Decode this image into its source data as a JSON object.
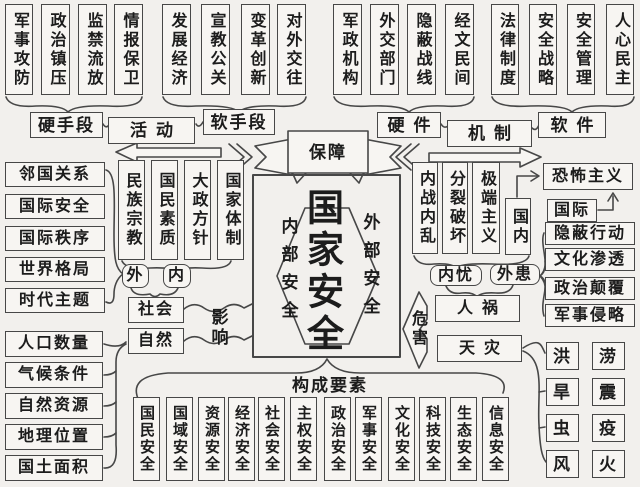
{
  "colors": {
    "background": "#f2f0ed",
    "box_background": "#f7f5f2",
    "border": "#474747",
    "text": "#1c1c1c"
  },
  "center": {
    "title": "国家安全",
    "inner_label": "内部安全",
    "outer_label": "外部安全"
  },
  "banner": {
    "label": "保障"
  },
  "top_left": {
    "hard_items": [
      "军事攻防",
      "政治镇压",
      "监禁流放",
      "情报保卫"
    ],
    "hard_label": "硬手段",
    "activity_label": "活动",
    "soft_items": [
      "发展经济",
      "宣教公关",
      "变革创新",
      "对外交往"
    ],
    "soft_label": "软手段"
  },
  "top_right": {
    "hardware_items": [
      "军政机构",
      "外交部门",
      "隐蔽战线",
      "经文民间"
    ],
    "hardware_label": "硬件",
    "mechanism_label": "机制",
    "software_items": [
      "法律制度",
      "安全战略",
      "安全管理",
      "人心民主"
    ],
    "software_label": "软件"
  },
  "left": {
    "world_items": [
      "邻国关系",
      "国际安全",
      "国际秩序",
      "世界格局",
      "时代主题"
    ],
    "domestic_items": [
      "民族宗教",
      "国民素质",
      "大政方针",
      "国家体制"
    ],
    "external_label": "外",
    "internal_label": "内",
    "society_label": "社会",
    "nature_label": "自然",
    "influence_label": "影响",
    "geo_items": [
      "人口数量",
      "气候条件",
      "自然资源",
      "地理位置",
      "国土面积"
    ]
  },
  "right": {
    "internal_threat_items": [
      "内战内乱",
      "分裂破坏",
      "极端主义"
    ],
    "domestic_label": "国内",
    "terrorism_label": "恐怖主义",
    "international_label": "国际",
    "external_threat_items": [
      "隐蔽行动",
      "文化渗透",
      "政治颠覆",
      "军事侵略"
    ],
    "internal_worry_label": "内忧",
    "external_worry_label": "外患",
    "manmade_label": "人祸",
    "natural_label": "天灾",
    "harm_label": "危害",
    "disaster_items": [
      "洪",
      "涝",
      "旱",
      "震",
      "虫",
      "疫",
      "风",
      "火"
    ]
  },
  "bottom": {
    "label": "构成要素",
    "element_items": [
      "国民安全",
      "国域安全",
      "资源安全",
      "经济安全",
      "社会安全",
      "主权安全",
      "政治安全",
      "军事安全",
      "文化安全",
      "科技安全",
      "生态安全",
      "信息安全"
    ]
  }
}
